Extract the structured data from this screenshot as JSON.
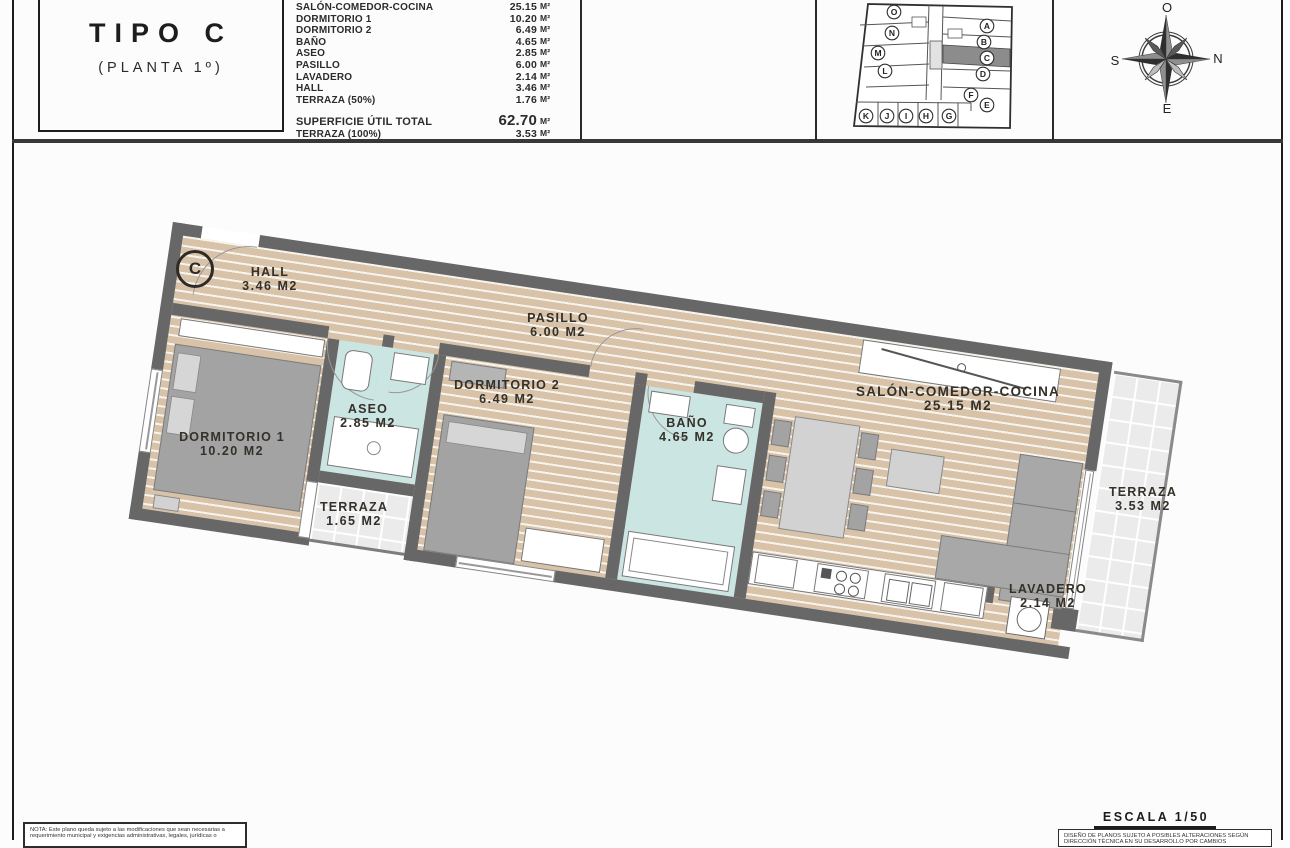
{
  "header": {
    "title": "TIPO C",
    "subtitle": "(PLANTA 1º)",
    "areas": {
      "rows": [
        {
          "label": "SALÓN-COMEDOR-COCINA",
          "value": "25.15",
          "unit": "M²"
        },
        {
          "label": "DORMITORIO 1",
          "value": "10.20",
          "unit": "M²"
        },
        {
          "label": "DORMITORIO 2",
          "value": "6.49",
          "unit": "M²"
        },
        {
          "label": "BAÑO",
          "value": "4.65",
          "unit": "M²"
        },
        {
          "label": "ASEO",
          "value": "2.85",
          "unit": "M²"
        },
        {
          "label": "PASILLO",
          "value": "6.00",
          "unit": "M²"
        },
        {
          "label": "LAVADERO",
          "value": "2.14",
          "unit": "M²"
        },
        {
          "label": "HALL",
          "value": "3.46",
          "unit": "M²"
        },
        {
          "label": "TERRAZA (50%)",
          "value": "1.76",
          "unit": "M²"
        }
      ],
      "total": {
        "label": "SUPERFICIE ÚTIL TOTAL",
        "value": "62.70",
        "unit": "M²"
      },
      "terraza_total": {
        "label": "TERRAZA (100%)",
        "value": "3.53",
        "unit": "M²"
      }
    },
    "keyplan": {
      "highlighted": "C",
      "units": [
        "O",
        "N",
        "M",
        "L",
        "K",
        "J",
        "I",
        "H",
        "G",
        "A",
        "B",
        "C",
        "D",
        "F",
        "E"
      ]
    },
    "compass": {
      "top": "O",
      "right": "N",
      "left": "S",
      "bottom": "E"
    }
  },
  "plan": {
    "unit_marker": "C",
    "rooms": [
      {
        "name": "HALL",
        "area": "3.46 M2"
      },
      {
        "name": "PASILLO",
        "area": "6.00 M2"
      },
      {
        "name": "DORMITORIO 1",
        "area": "10.20 M2"
      },
      {
        "name": "ASEO",
        "area": "2.85 M2"
      },
      {
        "name": "TERRAZA",
        "area": "1.65 M2"
      },
      {
        "name": "DORMITORIO 2",
        "area": "6.49 M2"
      },
      {
        "name": "BAÑO",
        "area": "4.65 M2"
      },
      {
        "name": "SALÓN-COMEDOR-COCINA",
        "area": "25.15 M2"
      },
      {
        "name": "TERRAZA",
        "area": "3.53 M2"
      },
      {
        "name": "LAVADERO",
        "area": "2.14 M2"
      }
    ]
  },
  "footer": {
    "note_line1": "NOTA: Este plano queda sujeto a las modificaciones que sean necesarias a",
    "note_line2": "requerimiento municipal y exigencias administrativas, legales, jurídicas o",
    "escala": "ESCALA 1/50",
    "disclaimer_line1": "DISEÑO DE PLANOS SUJETO A POSIBLES ALTERACIONES SEGÚN",
    "disclaimer_line2": "DIRECCIÓN TÉCNICA EN SU DESARROLLO POR CAMBIOS"
  },
  "colors": {
    "wood": "#d9c3a8",
    "wall": "#676767",
    "wet_floor": "#cbe5e2",
    "tile": "#ebebeb",
    "ink": "#2b2b2b"
  }
}
